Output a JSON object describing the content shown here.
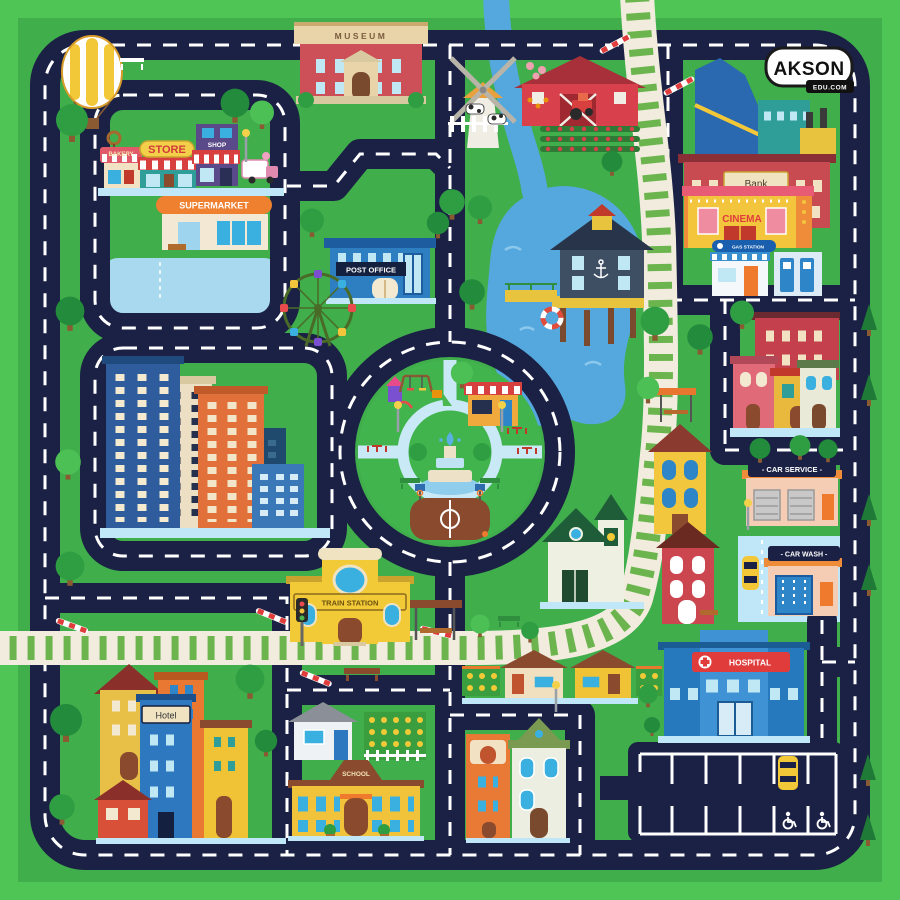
{
  "logo": {
    "brand": "AKSON",
    "domain": "EDU.COM"
  },
  "labels": {
    "museum": "MUSEUM",
    "bakery": "BAKERY",
    "store": "STORE",
    "shop": "SHOP",
    "supermarket": "SUPERMARKET",
    "post_office": "POST OFFICE",
    "bank": "Bank",
    "cinema": "CINEMA",
    "gas_station": "GAS STATION",
    "car_service": "- CAR SERVICE -",
    "car_wash": "- CAR WASH -",
    "hospital": "HOSPITAL",
    "train_station": "TRAIN STATION",
    "hotel": "Hotel",
    "school": "SCHOOL"
  },
  "colors": {
    "border_green": "#4ec554",
    "grass_green": "#3fae4b",
    "road_navy": "#1b2144",
    "road_dash": "#ffffff",
    "water_blue": "#55a8de",
    "pond_blue": "#a8d9ee",
    "sidewalk_blue": "#bfe7f7",
    "rail_base": "#f1ecdd",
    "rail_tie": "#6cb54e",
    "hospital_red": "#e03c3c",
    "sign_navy": "#1b2144",
    "sign_yellow": "#f2c937"
  }
}
